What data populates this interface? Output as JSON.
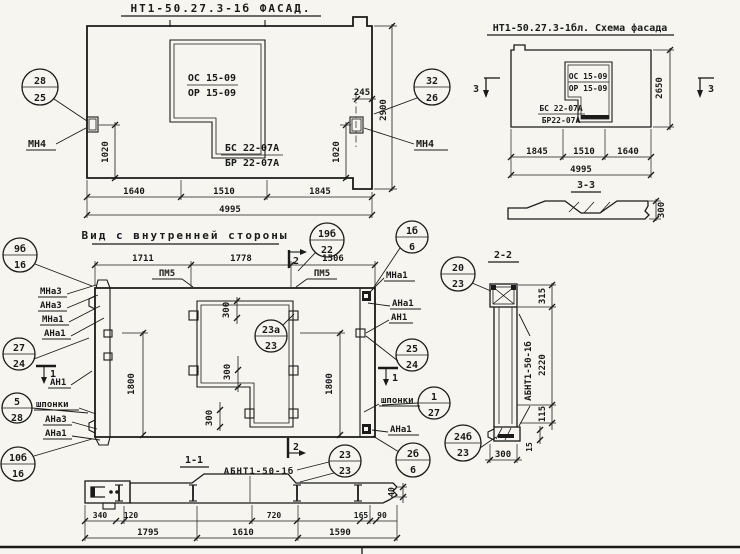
{
  "sheet": {
    "bg": "#f6f5ef",
    "ink": "#1a1a1a"
  },
  "facade": {
    "title": "НТ1-50.27.3-1б ФАСАД.",
    "window_mark_top": "ОС 15-09",
    "window_mark_bottom": "ОР 15-09",
    "lintel_mark_top": "БС 22-07А",
    "lintel_mark_bottom": "БР 22-07А",
    "anchor_label": "МН4",
    "callout_left_top": "28",
    "callout_left_bottom": "25",
    "callout_right_top": "32",
    "callout_right_bottom": "26",
    "dim_245": "245",
    "dim_2900": "2900",
    "dim_1020": "1020",
    "dims_bottom": [
      "1640",
      "1510",
      "1845"
    ],
    "dim_total": "4995"
  },
  "schema": {
    "title": "НТ1-50.27.3-1бл. Схема фасада",
    "window_mark_top": "ОС 15-09",
    "window_mark_bottom": "ОР 15-09",
    "lintel_mark_top": "БС 22-07А",
    "lintel_mark_bottom": "БР22-07А",
    "dim_height": "2650",
    "section_label": "3",
    "dims_bottom": [
      "1845",
      "1510",
      "1640"
    ],
    "dim_total": "4995"
  },
  "section33": {
    "title": "3-3",
    "dim_thickness": "300"
  },
  "inner": {
    "title": "Вид с внутренней стороны",
    "dims_top": [
      "1711",
      "1778",
      "1506"
    ],
    "plate_label": "ПМ5",
    "section1_label": "1",
    "section2_label": "2",
    "dim_1800": "1800",
    "dim_300": "300",
    "labels_left": [
      "МНа3",
      "АНа3",
      "МНа1",
      "АНа1"
    ],
    "label_an1": "АН1",
    "label_keys": "шпонки",
    "labels_left_lower": [
      "АНа3",
      "АНа1"
    ],
    "labels_right": [
      "МНа1",
      "АНа1",
      "АН1"
    ],
    "label_right_bottom": "АНа1",
    "callouts": {
      "c9b_16": {
        "top": "9б",
        "bottom": "16"
      },
      "c27_24": {
        "top": "27",
        "bottom": "24"
      },
      "c5_28": {
        "top": "5",
        "bottom": "28"
      },
      "c10b_16": {
        "top": "10б",
        "bottom": "16"
      },
      "c19b_22": {
        "top": "19б",
        "bottom": "22"
      },
      "c1b_6": {
        "top": "1б",
        "bottom": "6"
      },
      "c23a_23": {
        "top": "23а",
        "bottom": "23"
      },
      "c25_24": {
        "top": "25",
        "bottom": "24"
      },
      "c1_27": {
        "top": "1",
        "bottom": "27"
      },
      "c23_23": {
        "top": "23",
        "bottom": "23"
      },
      "c2b_6": {
        "top": "2б",
        "bottom": "6"
      }
    }
  },
  "section11": {
    "title": "1-1",
    "product_label": "АБНТ1-50-1б",
    "dims_row1": [
      "340",
      "120",
      "720",
      "165",
      "90"
    ],
    "dim_40": "40",
    "dims_row2": [
      "1795",
      "1610",
      "1590"
    ]
  },
  "section22": {
    "title": "2-2",
    "product_label": "АБНТ1-50-1б",
    "callout_top": {
      "top": "20",
      "bottom": "23"
    },
    "callout_bottom": {
      "top": "24б",
      "bottom": "23"
    },
    "dim_315": "315",
    "dim_2220": "2220",
    "dim_115": "115",
    "dim_15": "15",
    "dim_300": "300"
  }
}
